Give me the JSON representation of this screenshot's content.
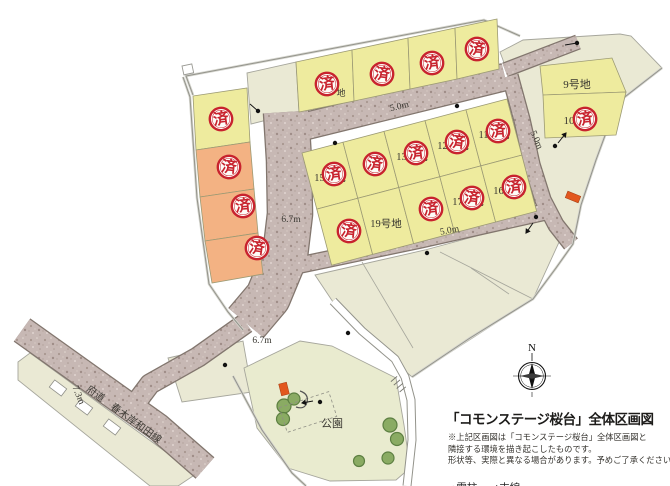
{
  "title_block": {
    "title": "「コモンステージ桜台」全体区画図",
    "notes": [
      "※上記区画図は「コモンステージ桜台」全体区画図と",
      "隣接する環境を描き起こしたものです。",
      "形状等、実際と異なる場合があります。予めご了承ください。"
    ],
    "legend": {
      "pole": "●電柱",
      "wire": "↑支線"
    },
    "compass_n": "N"
  },
  "colors": {
    "lot_yellow": "#eeeb9e",
    "lot_orange": "#f3b283",
    "parcel": "#eae9d4",
    "park": "#e9ebcf",
    "road_base": "#c7b8b4",
    "road_edge": "#82766e",
    "stamp_red": "#c8232e",
    "boundary": "#93938b",
    "tree": "#8aab63",
    "marker_orange": "#e2571e"
  },
  "map": {
    "stamp_char": "済",
    "roads": [
      {
        "d": "M 22,330 L 92,380 L 158,427 L 205,468",
        "w": 26
      },
      {
        "d": "M 246,323 L 198,357 L 150,384 L 138,400",
        "w": 19
      },
      {
        "d": "M 286,112 L 289,160 L 290,214 L 285,256 L 268,297 L 246,323",
        "w": 44
      },
      {
        "d": "M 290,130 L 505,77",
        "w": 26
      },
      {
        "d": "M 505,70 L 578,42",
        "w": 13
      },
      {
        "d": "M 510,76 L 522,120 L 532,165 L 543,200 L 556,225 L 571,244",
        "w": 15
      },
      {
        "d": "M 300,265 L 420,240 L 545,212",
        "w": 15
      }
    ],
    "thin_roads": [
      {
        "d": "M 333,301 L 362,331 L 395,359 L 405,377 L 411,400 L 412,440 L 407,486",
        "w": 7
      }
    ],
    "boundaries": [
      {
        "d": "M 193,95 L 186,76 L 484,20 L 520,36"
      },
      {
        "d": "M 183,77 L 190,97 L 197,198 L 209,284 L 228,312 L 243,330"
      },
      {
        "d": "M 233,376 L 262,430 L 292,473 L 306,486"
      },
      {
        "d": "M 662,68 L 617,103 L 596,160 L 581,205 L 573,244 L 556,268 L 533,299 L 470,338 L 412,377"
      }
    ],
    "parcels": [
      {
        "pts": "500,52 523,40 620,34 631,36 662,68 617,103 596,160 581,205 573,244 560,240 543,218 536,185 520,115 503,60",
        "t": "parcel"
      },
      {
        "pts": "315,275 425,250 543,218 560,240 533,299 412,377 404,370 362,331 333,302",
        "t": "parcel"
      },
      {
        "pts": "247,73 296,62 299,112 251,124",
        "t": "parcel"
      },
      {
        "pts": "168,358 243,341 252,392 182,402",
        "t": "parcel"
      },
      {
        "pts": "30,353 196,474 178,486 150,486 18,380 18,362",
        "t": "parcel"
      },
      {
        "pts": "244,368 300,341 332,346 360,360 396,378 404,425 410,468 396,480 330,481 288,468 257,428",
        "t": "park"
      }
    ],
    "parcel_lines": [
      {
        "x1": 362,
        "y1": 262,
        "x2": 413,
        "y2": 348
      },
      {
        "x1": 471,
        "y1": 268,
        "x2": 509,
        "y2": 294
      },
      {
        "x1": 440,
        "y1": 252,
        "x2": 533,
        "y2": 299
      }
    ],
    "lots": [
      {
        "pts": "193,96 247,88 250,142 196,150",
        "c": "y",
        "label": "",
        "sold": true,
        "sx": 221,
        "sy": 119,
        "sr": -8
      },
      {
        "pts": "196,150 250,142 254,189 200,197",
        "c": "o",
        "label": "",
        "sold": true,
        "sx": 229,
        "sy": 167,
        "sr": 6
      },
      {
        "pts": "200,197 254,189 258,233 205,241",
        "c": "o",
        "label": "",
        "sold": true,
        "sx": 243,
        "sy": 206,
        "sr": -5
      },
      {
        "pts": "205,241 258,233 263,274 212,283",
        "c": "o",
        "label": "",
        "sold": true,
        "sx": 257,
        "sy": 248,
        "sr": 8
      },
      {
        "pts": "296,62 352,50 354,101 299,112",
        "c": "y",
        "label": "",
        "sold": true,
        "sx": 327,
        "sy": 84,
        "sr": -6
      },
      {
        "pts": "352,50 408,38 410,89 354,101",
        "c": "y",
        "label": "",
        "sold": true,
        "sx": 382,
        "sy": 74,
        "sr": 7
      },
      {
        "pts": "408,38 455,28 457,79 410,89",
        "c": "y",
        "label": "",
        "sold": true,
        "sx": 432,
        "sy": 63,
        "sr": -7
      },
      {
        "pts": "455,28 497,19 499,69 457,79",
        "c": "y",
        "label": "",
        "sold": true,
        "sx": 477,
        "sy": 49,
        "sr": 5
      },
      {
        "pts": "540,66 612,58 626,92 543,95",
        "c": "y",
        "label": "9号地",
        "lx": 577,
        "ly": 88,
        "ls": 11,
        "sold": false
      },
      {
        "pts": "543,95 626,92 616,135 545,138",
        "c": "y",
        "label": "10号地",
        "lx": 580,
        "ly": 124,
        "ls": 11,
        "sold": true,
        "sx": 585,
        "sy": 119,
        "sr": -8
      },
      {
        "pts": "302,153 343,142.2 357.8,198.3 316.8,209.1",
        "c": "y",
        "label": "15号地",
        "lx": 330,
        "ly": 181,
        "ls": 10.5,
        "sold": true,
        "sx": 334,
        "sy": 174,
        "sr": -7
      },
      {
        "pts": "343,142.2 384,131.4 398.8,187.5 357.8,198.3",
        "c": "y",
        "label": "",
        "sold": true,
        "sx": 375,
        "sy": 164,
        "sr": 6
      },
      {
        "pts": "384,131.4 425,120.6 439.8,176.7 398.8,187.5",
        "c": "y",
        "label": "13号地",
        "lx": 412,
        "ly": 160,
        "ls": 10.5,
        "sold": true,
        "sx": 416,
        "sy": 153,
        "sr": -6
      },
      {
        "pts": "425,120.6 466,109.8 480.8,165.9 439.8,176.7",
        "c": "y",
        "label": "12号地",
        "lx": 453,
        "ly": 149,
        "ls": 10.5,
        "sold": true,
        "sx": 457,
        "sy": 142,
        "sr": 7
      },
      {
        "pts": "466,109.8 507,99 521.8,155.1 480.8,165.9",
        "c": "y",
        "label": "11号地",
        "lx": 494,
        "ly": 138,
        "ls": 10.5,
        "sold": true,
        "sx": 498,
        "sy": 131,
        "sr": -5
      },
      {
        "pts": "316.8,209.1 357.8,198.3 372.6,254.4 331.6,265.2",
        "c": "y",
        "label": "",
        "sold": true,
        "sx": 349,
        "sy": 231,
        "sr": 6
      },
      {
        "pts": "357.8,198.3 398.8,187.5 413.6,243.6 372.6,254.4",
        "c": "y",
        "label": "19号地",
        "lx": 386,
        "ly": 227,
        "ls": 10.5,
        "sold": false
      },
      {
        "pts": "398.8,187.5 439.8,176.7 454.6,232.8 413.6,243.6",
        "c": "y",
        "label": "",
        "sold": true,
        "sx": 431,
        "sy": 209,
        "sr": -7
      },
      {
        "pts": "439.8,176.7 480.8,165.9 495.6,222 454.6,232.8",
        "c": "y",
        "label": "17号地",
        "lx": 468,
        "ly": 205,
        "ls": 10.5,
        "sold": true,
        "sx": 472,
        "sy": 198,
        "sr": 6
      },
      {
        "pts": "480.8,165.9 521.8,155.1 536.6,211.2 495.6,222",
        "c": "y",
        "label": "16号地",
        "lx": 509,
        "ly": 194,
        "ls": 10.5,
        "sold": true,
        "sx": 514,
        "sy": 187,
        "sr": -6
      }
    ],
    "labels": [
      {
        "t": "5.0m",
        "x": 400,
        "y": 109,
        "r": -13.5,
        "s": 9.5
      },
      {
        "t": "5.0m",
        "x": 450,
        "y": 233,
        "r": -11,
        "s": 9.5
      },
      {
        "t": "5.0m",
        "x": 534,
        "y": 141,
        "r": 66,
        "s": 9.5
      },
      {
        "t": "6.7m",
        "x": 291,
        "y": 222,
        "r": 0,
        "s": 9.5
      },
      {
        "t": "6.7m",
        "x": 262,
        "y": 343,
        "r": 0,
        "s": 9.5
      },
      {
        "t": "7.3m",
        "x": 76,
        "y": 396,
        "r": 68,
        "s": 9.5
      },
      {
        "t": "府道　春木岸和田線",
        "x": 122,
        "y": 417,
        "r": 36,
        "s": 10
      },
      {
        "t": "公園",
        "x": 332,
        "y": 427,
        "r": 0,
        "s": 11
      },
      {
        "t": "地",
        "x": 341,
        "y": 96,
        "r": 0,
        "s": 9
      }
    ],
    "trees": [
      {
        "x": 284,
        "y": 406,
        "r": 7
      },
      {
        "x": 294,
        "y": 399,
        "r": 6
      },
      {
        "x": 283,
        "y": 419,
        "r": 6.5
      },
      {
        "x": 390,
        "y": 425,
        "r": 7
      },
      {
        "x": 397,
        "y": 439,
        "r": 6.5
      },
      {
        "x": 388,
        "y": 458,
        "r": 6
      },
      {
        "x": 359,
        "y": 461,
        "r": 5.5
      }
    ],
    "poles": [
      {
        "x": 258,
        "y": 111,
        "fx": 250,
        "fy": 104
      },
      {
        "x": 457,
        "y": 106
      },
      {
        "x": 335,
        "y": 143
      },
      {
        "x": 577,
        "y": 43,
        "fx": 565,
        "fy": 45
      },
      {
        "x": 555,
        "y": 146
      },
      {
        "x": 536,
        "y": 217
      },
      {
        "x": 427,
        "y": 253
      },
      {
        "x": 348,
        "y": 333
      },
      {
        "x": 225,
        "y": 365
      },
      {
        "x": 320,
        "y": 402
      }
    ],
    "arrows": [
      {
        "x1": 558,
        "y1": 143,
        "x2": 566,
        "y2": 133
      },
      {
        "x1": 533,
        "y1": 223,
        "x2": 526,
        "y2": 233
      },
      {
        "x1": 313,
        "y1": 401,
        "x2": 302,
        "y2": 403
      }
    ],
    "markers": [
      {
        "x": 573,
        "y": 197,
        "w": 14,
        "h": 7,
        "r": 22
      },
      {
        "x": 284,
        "y": 389,
        "w": 8,
        "h": 12,
        "r": -14
      }
    ],
    "buildings": [
      {
        "x": 58,
        "y": 388,
        "w": 15,
        "h": 9,
        "r": 37
      },
      {
        "x": 84,
        "y": 407,
        "w": 15,
        "h": 9,
        "r": 37
      },
      {
        "x": 112,
        "y": 427,
        "w": 15,
        "h": 9,
        "r": 37
      }
    ],
    "steps": [
      {
        "x1": 397.1,
        "y1": 376.4,
        "x2": 390.9,
        "y2": 381.6
      },
      {
        "x1": 400,
        "y1": 379.9,
        "x2": 393.8,
        "y2": 385.1
      },
      {
        "x1": 402.9,
        "y1": 383.3,
        "x2": 396.7,
        "y2": 388.5
      },
      {
        "x1": 405.8,
        "y1": 386.8,
        "x2": 399.6,
        "y2": 392
      }
    ],
    "dash_rect": {
      "x": 308,
      "y": 412,
      "w": 52,
      "h": 26,
      "r": -18
    },
    "notch": {
      "x": 182,
      "y": 66,
      "w": 10,
      "h": 9,
      "r": -12
    }
  }
}
